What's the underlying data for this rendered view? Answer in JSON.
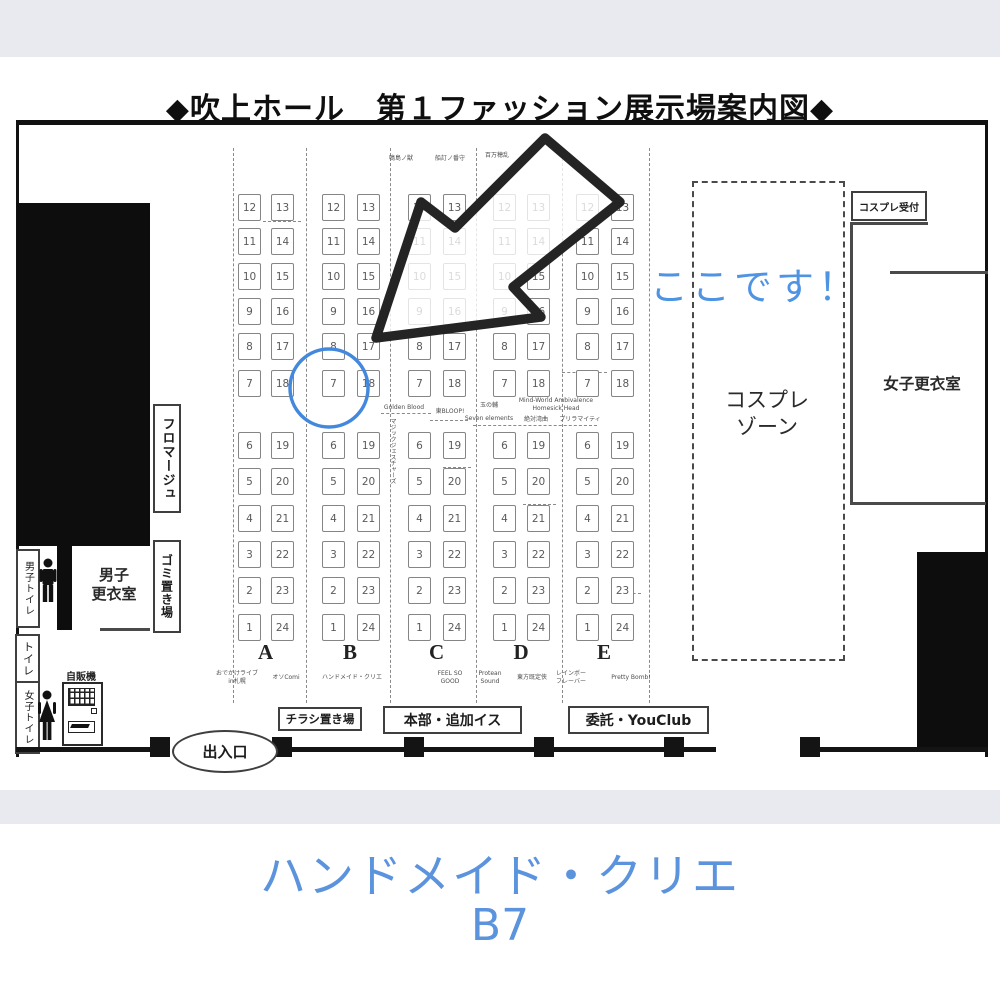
{
  "title": "◆吹上ホール　第１ファッション展示場案内図◆",
  "annotation": {
    "here": "ここです！",
    "circled_booth": "B7"
  },
  "caption": {
    "line1": "ハンドメイド・クリエ",
    "line2": "B7"
  },
  "colors": {
    "highlight_blue": "#4488dd",
    "caption_blue": "#5b93dd",
    "wall_black": "#0d0d0d"
  },
  "grid": {
    "column_letters": [
      "A",
      "B",
      "C",
      "D",
      "E"
    ],
    "top_left": [
      12,
      11,
      10,
      9,
      8,
      7
    ],
    "top_right": [
      13,
      14,
      15,
      16,
      17,
      18
    ],
    "bottom_left": [
      6,
      5,
      4,
      3,
      2,
      1
    ],
    "bottom_right": [
      19,
      20,
      21,
      22,
      23,
      24
    ]
  },
  "map_labels": {
    "top": [
      {
        "text": "鳴島ノ獣",
        "x": 401,
        "y": 156
      },
      {
        "text": "船訂ノ番守",
        "x": 450,
        "y": 156
      },
      {
        "text": "百万穂乱",
        "x": 497,
        "y": 153
      }
    ],
    "mid": [
      {
        "text": "Golden Blood",
        "x": 404,
        "y": 405
      },
      {
        "text": "東BLOOP!",
        "x": 450,
        "y": 409
      },
      {
        "text": "玉の輔",
        "x": 489,
        "y": 403
      },
      {
        "text": "Seven elements",
        "x": 489,
        "y": 416
      },
      {
        "text": "Mind-World Ambivalence",
        "x": 556,
        "y": 398
      },
      {
        "text": "Homesick Head",
        "x": 556,
        "y": 406
      },
      {
        "text": "絶対湾曲",
        "x": 536,
        "y": 417
      },
      {
        "text": "プリラマイティ",
        "x": 580,
        "y": 417
      },
      {
        "text": "マジックジェスチャーズ",
        "x": 390,
        "y": 418,
        "vertical": true
      }
    ],
    "bottom": [
      {
        "text": "おでかけライブ",
        "x": 237,
        "y": 671
      },
      {
        "text": "in札幌",
        "x": 237,
        "y": 679
      },
      {
        "text": "オソComi",
        "x": 286,
        "y": 675
      },
      {
        "text": "ハンドメイド・クリエ",
        "x": 352,
        "y": 675
      },
      {
        "text": "FEEL SO",
        "x": 450,
        "y": 671
      },
      {
        "text": "GOOD",
        "x": 450,
        "y": 679
      },
      {
        "text": "Protean",
        "x": 490,
        "y": 671
      },
      {
        "text": "Sound",
        "x": 490,
        "y": 679
      },
      {
        "text": "東方既定侠",
        "x": 532,
        "y": 675
      },
      {
        "text": "レインボー",
        "x": 571,
        "y": 671
      },
      {
        "text": "フレーバー",
        "x": 571,
        "y": 679
      },
      {
        "text": "Pretty Bomb!",
        "x": 631,
        "y": 675
      }
    ]
  },
  "facilities": {
    "fromage": "フロマージュ",
    "trash": "ゴミ置き場",
    "mens_changing_l1": "男子",
    "mens_changing_l2": "更衣室",
    "mens_toilet": "男子トイレ",
    "toilet": "トイレ",
    "womens_toilet": "女子トイレ",
    "vending": "自販機",
    "cosplay_reception": "コスプレ受付",
    "cosplay_zone_l1": "コスプレ",
    "cosplay_zone_l2": "ゾーン",
    "womens_changing": "女子更衣室",
    "entrance": "出入口",
    "flyer_area": "チラシ置き場",
    "hq": "本部・追加イス",
    "consignment": "委託・YouClub"
  }
}
